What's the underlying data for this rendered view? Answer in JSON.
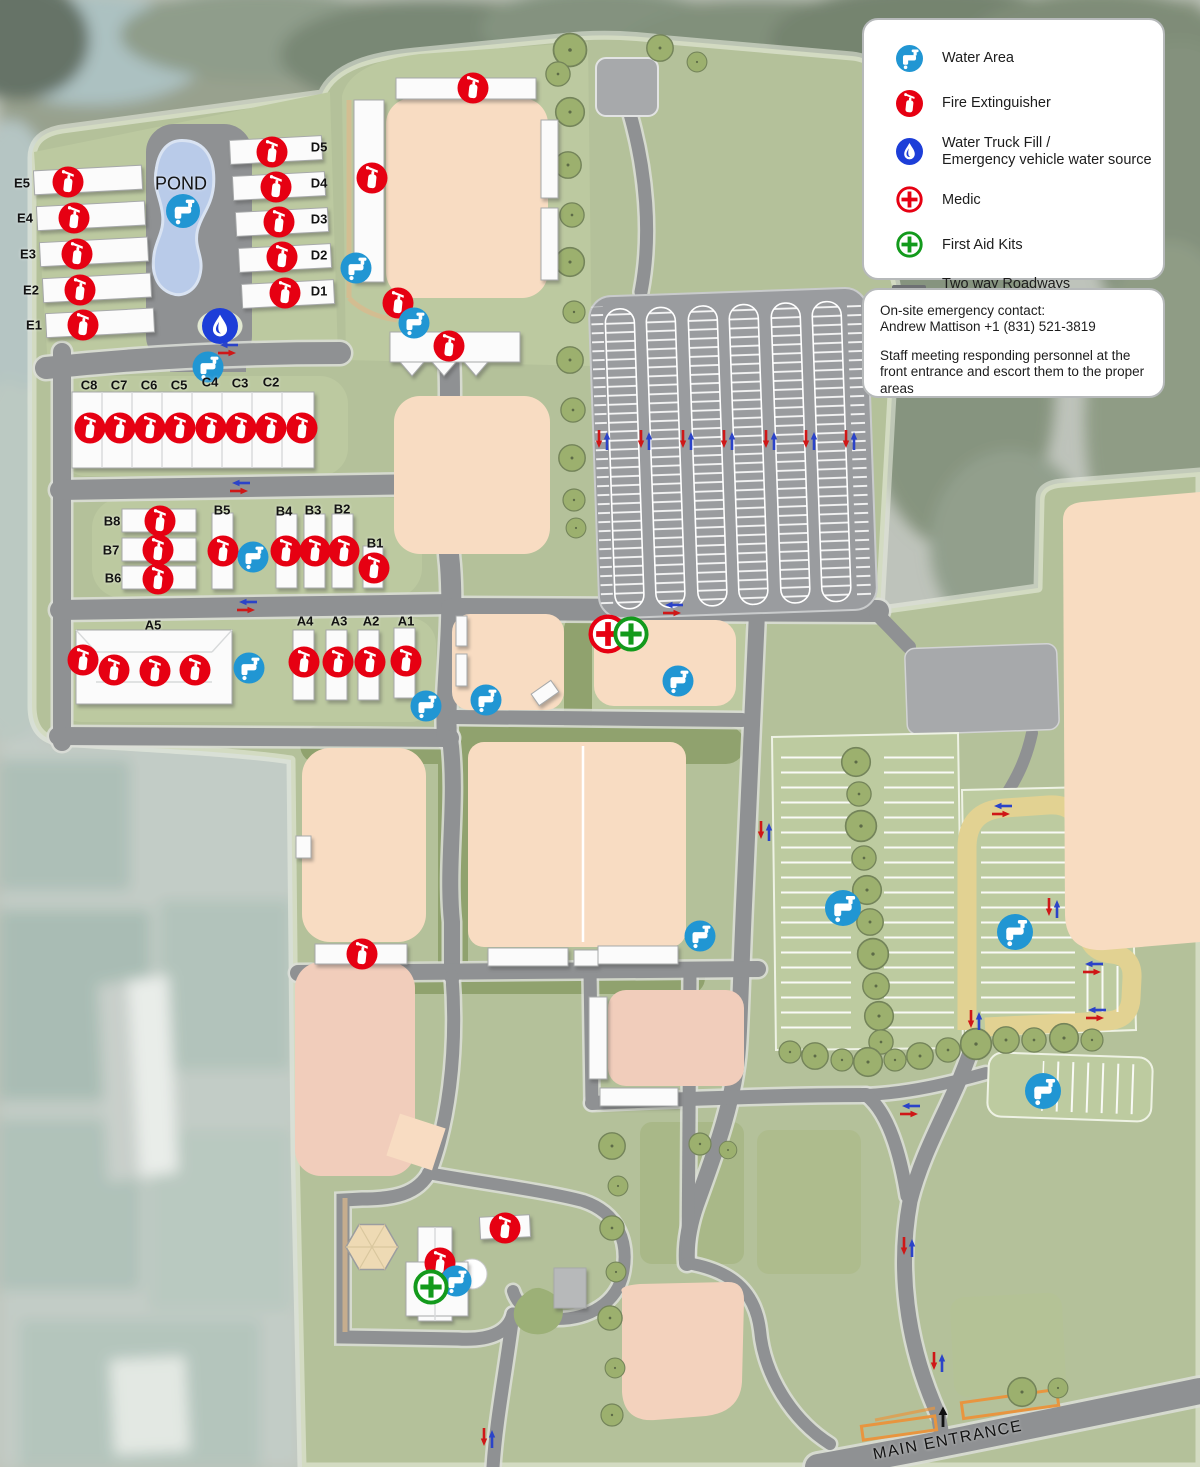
{
  "legend": {
    "items": [
      {
        "icon": "water-tap",
        "label_lines": [
          "Water Area"
        ]
      },
      {
        "icon": "fire-extinguisher",
        "label_lines": [
          "Fire Extinguisher"
        ]
      },
      {
        "icon": "water-drop",
        "label_lines": [
          "Water Truck Fill /",
          "Emergency vehicle water source"
        ]
      },
      {
        "icon": "medic",
        "label_lines": [
          "Medic"
        ]
      },
      {
        "icon": "first-aid",
        "label_lines": [
          "First Aid Kits"
        ]
      },
      {
        "icon": "roadway",
        "label_lines": [
          "Two way Roadways",
          "(support fire apparatus)"
        ]
      }
    ]
  },
  "contact": {
    "line1": "On-site emergency contact:",
    "line2": "Andrew Mattison +1 (831) 521-3819",
    "line3": "Staff meeting responding personnel at the front entrance and escort them to the proper areas"
  },
  "colors": {
    "water_area": "#2196d3",
    "fire": "#e60012",
    "truck_fill": "#1d3ed8",
    "medic": "#e60012",
    "first_aid": "#139a1c",
    "roadway": "#6d7073"
  },
  "map": {
    "labels": [
      {
        "t": "E5",
        "x": 22,
        "y": 183
      },
      {
        "t": "E4",
        "x": 25,
        "y": 218
      },
      {
        "t": "E3",
        "x": 28,
        "y": 254
      },
      {
        "t": "E2",
        "x": 31,
        "y": 290
      },
      {
        "t": "E1",
        "x": 34,
        "y": 325
      },
      {
        "t": "D5",
        "x": 319,
        "y": 147
      },
      {
        "t": "D4",
        "x": 319,
        "y": 183
      },
      {
        "t": "D3",
        "x": 319,
        "y": 219
      },
      {
        "t": "D2",
        "x": 319,
        "y": 255
      },
      {
        "t": "D1",
        "x": 319,
        "y": 291
      },
      {
        "t": "C8",
        "x": 89,
        "y": 385
      },
      {
        "t": "C7",
        "x": 119,
        "y": 385
      },
      {
        "t": "C6",
        "x": 149,
        "y": 385
      },
      {
        "t": "C5",
        "x": 179,
        "y": 385
      },
      {
        "t": "C4",
        "x": 210,
        "y": 382
      },
      {
        "t": "C3",
        "x": 240,
        "y": 383
      },
      {
        "t": "C2",
        "x": 271,
        "y": 382
      },
      {
        "t": "B8",
        "x": 112,
        "y": 521
      },
      {
        "t": "B7",
        "x": 111,
        "y": 550
      },
      {
        "t": "B6",
        "x": 113,
        "y": 578
      },
      {
        "t": "B5",
        "x": 222,
        "y": 510
      },
      {
        "t": "B4",
        "x": 284,
        "y": 511
      },
      {
        "t": "B3",
        "x": 313,
        "y": 510
      },
      {
        "t": "B2",
        "x": 342,
        "y": 509
      },
      {
        "t": "B1",
        "x": 375,
        "y": 543
      },
      {
        "t": "A5",
        "x": 153,
        "y": 625
      },
      {
        "t": "A4",
        "x": 305,
        "y": 621
      },
      {
        "t": "A3",
        "x": 339,
        "y": 621
      },
      {
        "t": "A2",
        "x": 371,
        "y": 621
      },
      {
        "t": "A1",
        "x": 406,
        "y": 621
      },
      {
        "t": "POND",
        "x": 181,
        "y": 184,
        "s": 18,
        "w": "normal"
      },
      {
        "t": "MAIN ENTRANCE",
        "x": 948,
        "y": 1441,
        "s": 16,
        "w": "normal",
        "r": -11,
        "ls": 1.5
      }
    ],
    "markers": [
      {
        "type": "fire-extinguisher",
        "x": 68,
        "y": 182
      },
      {
        "type": "fire-extinguisher",
        "x": 74,
        "y": 218
      },
      {
        "type": "fire-extinguisher",
        "x": 77,
        "y": 254
      },
      {
        "type": "fire-extinguisher",
        "x": 80,
        "y": 290
      },
      {
        "type": "fire-extinguisher",
        "x": 83,
        "y": 325
      },
      {
        "type": "fire-extinguisher",
        "x": 272,
        "y": 152
      },
      {
        "type": "fire-extinguisher",
        "x": 276,
        "y": 187
      },
      {
        "type": "fire-extinguisher",
        "x": 279,
        "y": 222
      },
      {
        "type": "fire-extinguisher",
        "x": 282,
        "y": 257
      },
      {
        "type": "fire-extinguisher",
        "x": 285,
        "y": 293
      },
      {
        "type": "fire-extinguisher",
        "x": 90,
        "y": 428
      },
      {
        "type": "fire-extinguisher",
        "x": 120,
        "y": 428
      },
      {
        "type": "fire-extinguisher",
        "x": 150,
        "y": 428
      },
      {
        "type": "fire-extinguisher",
        "x": 180,
        "y": 428
      },
      {
        "type": "fire-extinguisher",
        "x": 211,
        "y": 428
      },
      {
        "type": "fire-extinguisher",
        "x": 241,
        "y": 428
      },
      {
        "type": "fire-extinguisher",
        "x": 271,
        "y": 428
      },
      {
        "type": "fire-extinguisher",
        "x": 302,
        "y": 428
      },
      {
        "type": "fire-extinguisher",
        "x": 160,
        "y": 521
      },
      {
        "type": "fire-extinguisher",
        "x": 158,
        "y": 550
      },
      {
        "type": "fire-extinguisher",
        "x": 158,
        "y": 579
      },
      {
        "type": "fire-extinguisher",
        "x": 223,
        "y": 551
      },
      {
        "type": "fire-extinguisher",
        "x": 286,
        "y": 551
      },
      {
        "type": "fire-extinguisher",
        "x": 315,
        "y": 551
      },
      {
        "type": "fire-extinguisher",
        "x": 344,
        "y": 551
      },
      {
        "type": "fire-extinguisher",
        "x": 374,
        "y": 568
      },
      {
        "type": "fire-extinguisher",
        "x": 83,
        "y": 660
      },
      {
        "type": "fire-extinguisher",
        "x": 114,
        "y": 670
      },
      {
        "type": "fire-extinguisher",
        "x": 155,
        "y": 671
      },
      {
        "type": "fire-extinguisher",
        "x": 195,
        "y": 670
      },
      {
        "type": "fire-extinguisher",
        "x": 304,
        "y": 662
      },
      {
        "type": "fire-extinguisher",
        "x": 338,
        "y": 662
      },
      {
        "type": "fire-extinguisher",
        "x": 370,
        "y": 662
      },
      {
        "type": "fire-extinguisher",
        "x": 406,
        "y": 661
      },
      {
        "type": "fire-extinguisher",
        "x": 473,
        "y": 88
      },
      {
        "type": "fire-extinguisher",
        "x": 372,
        "y": 178
      },
      {
        "type": "fire-extinguisher",
        "x": 398,
        "y": 303
      },
      {
        "type": "fire-extinguisher",
        "x": 449,
        "y": 346
      },
      {
        "type": "fire-extinguisher",
        "x": 362,
        "y": 954
      },
      {
        "type": "fire-extinguisher",
        "x": 505,
        "y": 1228
      },
      {
        "type": "fire-extinguisher",
        "x": 440,
        "y": 1263
      },
      {
        "type": "water-tap",
        "x": 183,
        "y": 211,
        "s": 34
      },
      {
        "type": "water-tap",
        "x": 208,
        "y": 367
      },
      {
        "type": "water-tap",
        "x": 356,
        "y": 268
      },
      {
        "type": "water-tap",
        "x": 414,
        "y": 323
      },
      {
        "type": "water-tap",
        "x": 253,
        "y": 557
      },
      {
        "type": "water-tap",
        "x": 249,
        "y": 668
      },
      {
        "type": "water-tap",
        "x": 426,
        "y": 706
      },
      {
        "type": "water-tap",
        "x": 486,
        "y": 700
      },
      {
        "type": "water-tap",
        "x": 678,
        "y": 681
      },
      {
        "type": "water-tap",
        "x": 700,
        "y": 936
      },
      {
        "type": "water-tap",
        "x": 843,
        "y": 908,
        "s": 36
      },
      {
        "type": "water-tap",
        "x": 1015,
        "y": 932,
        "s": 36
      },
      {
        "type": "water-tap",
        "x": 1043,
        "y": 1091,
        "s": 36
      },
      {
        "type": "water-tap",
        "x": 456,
        "y": 1281
      },
      {
        "type": "water-drop",
        "x": 220,
        "y": 326
      },
      {
        "type": "medic",
        "x": 608,
        "y": 634
      },
      {
        "type": "first-aid",
        "x": 631,
        "y": 634
      },
      {
        "type": "first-aid",
        "x": 431,
        "y": 1287
      },
      {
        "type": "arrows-h",
        "x": 228,
        "y": 349
      },
      {
        "type": "arrows-h",
        "x": 240,
        "y": 487
      },
      {
        "type": "arrows-h",
        "x": 247,
        "y": 606
      },
      {
        "type": "arrows-h",
        "x": 673,
        "y": 609
      },
      {
        "type": "arrows-h",
        "x": 1002,
        "y": 810
      },
      {
        "type": "arrows-h",
        "x": 1093,
        "y": 968
      },
      {
        "type": "arrows-h",
        "x": 1096,
        "y": 1014
      },
      {
        "type": "arrows-h",
        "x": 910,
        "y": 1110
      },
      {
        "type": "arrows-v",
        "x": 603,
        "y": 440
      },
      {
        "type": "arrows-v",
        "x": 645,
        "y": 440
      },
      {
        "type": "arrows-v",
        "x": 687,
        "y": 440
      },
      {
        "type": "arrows-v",
        "x": 728,
        "y": 440
      },
      {
        "type": "arrows-v",
        "x": 770,
        "y": 440
      },
      {
        "type": "arrows-v",
        "x": 810,
        "y": 440
      },
      {
        "type": "arrows-v",
        "x": 850,
        "y": 440
      },
      {
        "type": "arrows-v",
        "x": 765,
        "y": 831
      },
      {
        "type": "arrows-v",
        "x": 1053,
        "y": 908
      },
      {
        "type": "arrows-v",
        "x": 975,
        "y": 1020
      },
      {
        "type": "arrows-v",
        "x": 908,
        "y": 1247
      },
      {
        "type": "arrows-v",
        "x": 938,
        "y": 1362
      },
      {
        "type": "arrows-v",
        "x": 488,
        "y": 1438
      },
      {
        "type": "up-arrow",
        "x": 943,
        "y": 1417
      }
    ]
  }
}
